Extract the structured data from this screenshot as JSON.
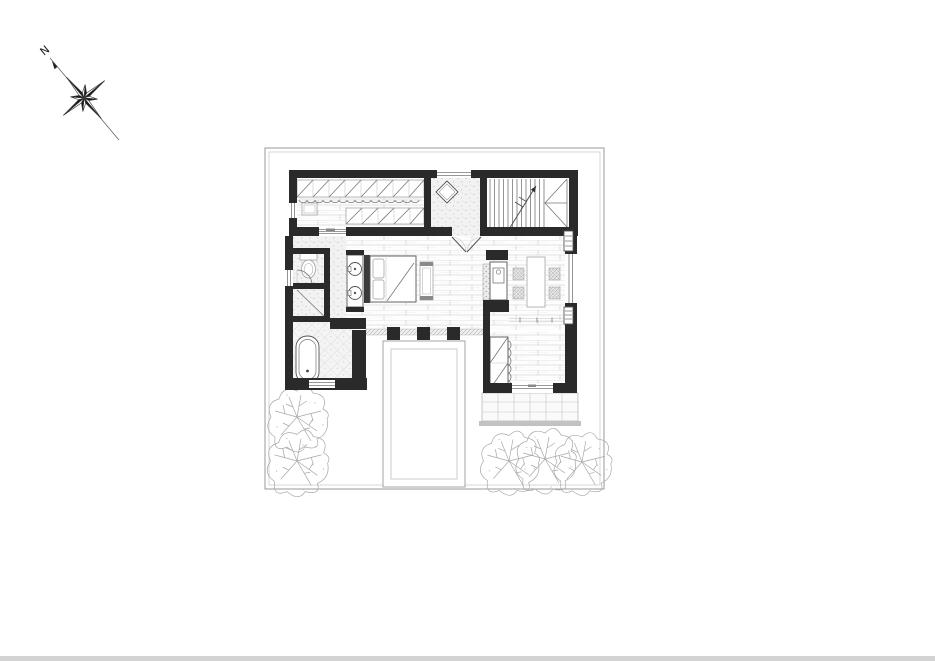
{
  "page": {
    "background": "#ffffff",
    "bottom_bar_color": "#d3d3d3"
  },
  "compass": {
    "label": "N"
  },
  "colors": {
    "wall": "#2a2a2a",
    "dark": "#1a1a1a",
    "line": "#777777",
    "light": "#c6c6c6",
    "dot": "#a8a8a8",
    "bar": "#d3d3d3",
    "tree": "#a8a8a8"
  },
  "plan": {
    "type": "architectural-floor-plan-upper-storey",
    "rooms": [
      {
        "name": "walk-in-closet"
      },
      {
        "name": "hallway"
      },
      {
        "name": "staircase"
      },
      {
        "name": "bathroom-wc"
      },
      {
        "name": "shower"
      },
      {
        "name": "bedroom"
      },
      {
        "name": "dining-area"
      },
      {
        "name": "bath-with-tub"
      },
      {
        "name": "study"
      },
      {
        "name": "terrace"
      },
      {
        "name": "void-below"
      }
    ],
    "fixtures": [
      "wardrobe-units",
      "dresser",
      "toilet",
      "double-vanity-sinks",
      "freestanding-bathtub",
      "double-bed",
      "bed-bench",
      "dining-table",
      "four-chairs",
      "counter-with-sink",
      "radiators",
      "stair-run-with-winder"
    ],
    "site": {
      "trees_left": 2,
      "trees_right": 3,
      "terrace_grid": true
    }
  }
}
